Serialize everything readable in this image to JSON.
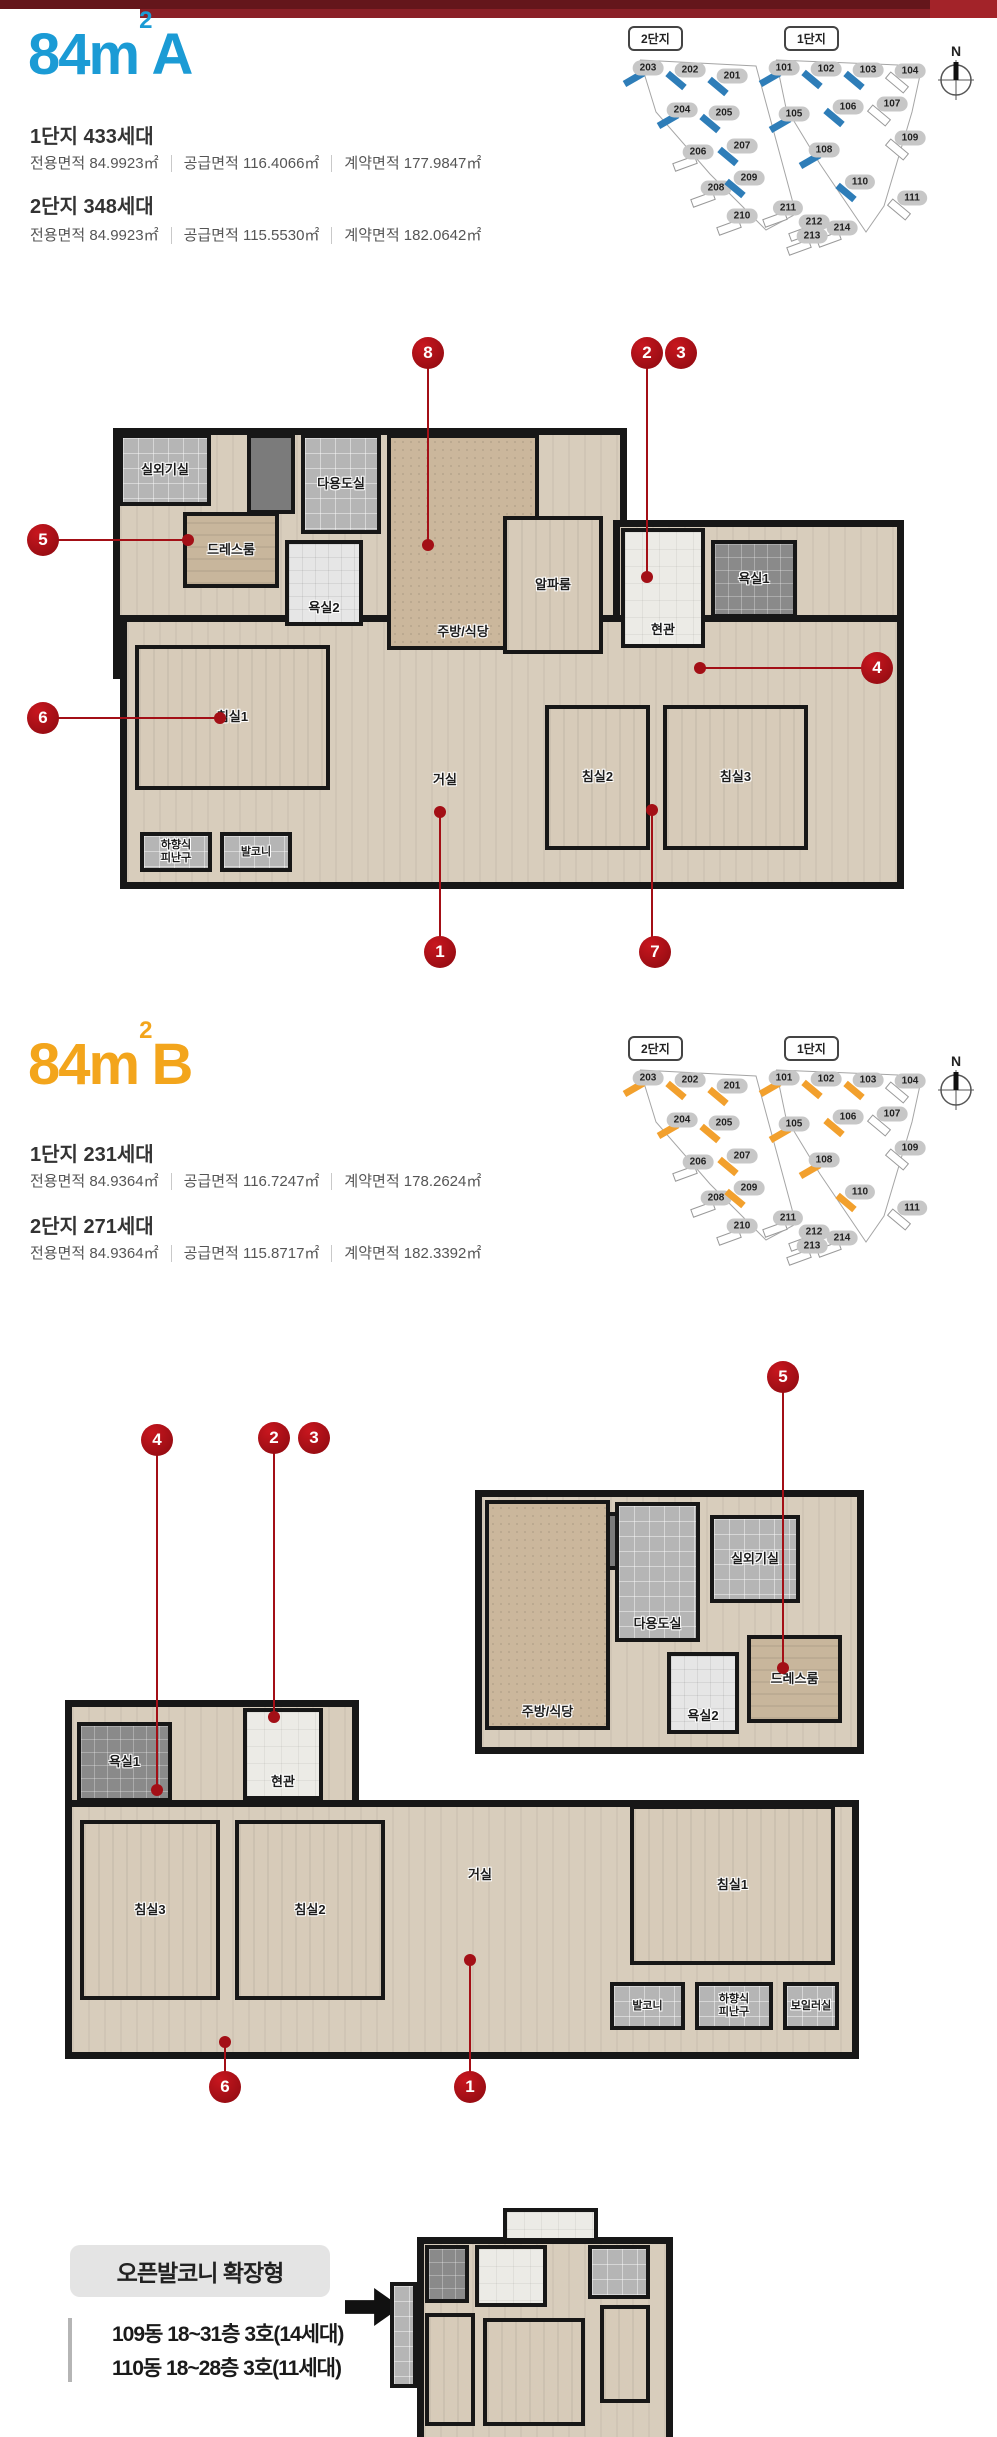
{
  "top_bar": {
    "color_left": "#64161b",
    "color_main": "#8a2027",
    "color_right": "#a32329"
  },
  "accents": {
    "marker": "#a30f16"
  },
  "site_map": {
    "labels": [
      "2단지",
      "1단지"
    ],
    "compass": "N",
    "buildings": [
      {
        "no": "203",
        "x": 32,
        "y": 52,
        "hl": true,
        "a": -30
      },
      {
        "no": "202",
        "x": 74,
        "y": 54,
        "hl": true,
        "a": 40
      },
      {
        "no": "201",
        "x": 116,
        "y": 60,
        "hl": true,
        "a": 40
      },
      {
        "no": "204",
        "x": 66,
        "y": 94,
        "hl": true,
        "a": -30
      },
      {
        "no": "205",
        "x": 108,
        "y": 97,
        "hl": true,
        "a": 40
      },
      {
        "no": "206",
        "x": 82,
        "y": 136,
        "hl": false,
        "a": -20
      },
      {
        "no": "207",
        "x": 126,
        "y": 130,
        "hl": true,
        "a": 40
      },
      {
        "no": "208",
        "x": 100,
        "y": 172,
        "hl": false,
        "a": -20
      },
      {
        "no": "209",
        "x": 133,
        "y": 162,
        "hl": true,
        "a": 40
      },
      {
        "no": "210",
        "x": 126,
        "y": 200,
        "hl": false,
        "a": -20
      },
      {
        "no": "211",
        "x": 172,
        "y": 192,
        "hl": false,
        "a": -20
      },
      {
        "no": "212",
        "x": 198,
        "y": 206,
        "hl": false,
        "a": -20
      },
      {
        "no": "214",
        "x": 226,
        "y": 212,
        "hl": false,
        "a": -20
      },
      {
        "no": "213",
        "x": 196,
        "y": 220,
        "hl": false,
        "a": -20
      },
      {
        "no": "101",
        "x": 168,
        "y": 52,
        "hl": true,
        "a": -30
      },
      {
        "no": "102",
        "x": 210,
        "y": 53,
        "hl": true,
        "a": 40
      },
      {
        "no": "103",
        "x": 252,
        "y": 54,
        "hl": true,
        "a": 40
      },
      {
        "no": "104",
        "x": 294,
        "y": 55,
        "hl": false,
        "a": 40
      },
      {
        "no": "105",
        "x": 178,
        "y": 98,
        "hl": true,
        "a": -30
      },
      {
        "no": "106",
        "x": 232,
        "y": 91,
        "hl": true,
        "a": 40
      },
      {
        "no": "107",
        "x": 276,
        "y": 88,
        "hl": false,
        "a": 40
      },
      {
        "no": "108",
        "x": 208,
        "y": 134,
        "hl": true,
        "a": -30
      },
      {
        "no": "109",
        "x": 294,
        "y": 122,
        "hl": false,
        "a": 40
      },
      {
        "no": "110",
        "x": 244,
        "y": 166,
        "hl": true,
        "a": 40
      },
      {
        "no": "111",
        "x": 296,
        "y": 182,
        "hl": false,
        "a": 40
      }
    ]
  },
  "sections": [
    {
      "id": "A",
      "title": {
        "main": "84m",
        "sup": "2",
        "type": "A",
        "color": "#1b9bd5"
      },
      "map_highlight": "#2e7db8",
      "complexes": [
        {
          "name": "1단지 433세대",
          "areas": [
            "전용면적 84.9923㎡",
            "공급면적 116.4066㎡",
            "계약면적 177.9847㎡"
          ]
        },
        {
          "name": "2단지 348세대",
          "areas": [
            "전용면적 84.9923㎡",
            "공급면적 115.5530㎡",
            "계약면적 182.0642㎡"
          ]
        }
      ],
      "plan": {
        "x": 105,
        "y": 420,
        "w": 785,
        "h": 455,
        "bases": [
          {
            "x": 8,
            "y": 8,
            "w": 500,
            "h": 237
          },
          {
            "x": 508,
            "y": 100,
            "w": 277,
            "h": 137
          },
          {
            "x": 15,
            "y": 195,
            "w": 770,
            "h": 260
          }
        ],
        "rooms": [
          {
            "id": "outdoor-unit-room",
            "label": "실외기실",
            "x": 14,
            "y": 14,
            "w": 92,
            "h": 72,
            "t": "tile"
          },
          {
            "id": "shaft",
            "x": 142,
            "y": 14,
            "w": 48,
            "h": 80,
            "t": "dark"
          },
          {
            "id": "utility-room",
            "label": "다용도실",
            "x": 196,
            "y": 14,
            "w": 80,
            "h": 100,
            "t": "tile"
          },
          {
            "id": "dress-room",
            "label": "드레스룸",
            "x": 78,
            "y": 92,
            "w": 96,
            "h": 76,
            "t": "wood2"
          },
          {
            "id": "bathroom-2",
            "label": "욕실2",
            "x": 180,
            "y": 120,
            "w": 78,
            "h": 86,
            "t": "bath2",
            "lb": true
          },
          {
            "id": "kitchen-dining",
            "label": "주방/식당",
            "x": 282,
            "y": 14,
            "w": 152,
            "h": 216,
            "t": "counter",
            "lb": true
          },
          {
            "id": "alpha-room",
            "label": "알파룸",
            "x": 398,
            "y": 96,
            "w": 100,
            "h": 138,
            "t": "wood"
          },
          {
            "id": "entrance",
            "label": "현관",
            "x": 516,
            "y": 108,
            "w": 84,
            "h": 120,
            "t": "entry",
            "lb": true
          },
          {
            "id": "bathroom-1",
            "label": "욕실1",
            "x": 606,
            "y": 120,
            "w": 86,
            "h": 78,
            "t": "bath"
          },
          {
            "id": "bedroom-1",
            "label": "침실1",
            "x": 30,
            "y": 225,
            "w": 195,
            "h": 145,
            "t": "wood"
          },
          {
            "id": "living-room",
            "label": "거실",
            "x": 280,
            "y": 330,
            "w": 120,
            "h": 60,
            "t": "none"
          },
          {
            "id": "bedroom-2",
            "label": "침실2",
            "x": 440,
            "y": 285,
            "w": 105,
            "h": 145,
            "t": "wood"
          },
          {
            "id": "bedroom-3",
            "label": "침실3",
            "x": 558,
            "y": 285,
            "w": 145,
            "h": 145,
            "t": "wood"
          },
          {
            "id": "escape-hatch",
            "label": "하향식\n피난구",
            "x": 35,
            "y": 412,
            "w": 72,
            "h": 40,
            "t": "tile",
            "s": true
          },
          {
            "id": "balcony",
            "label": "발코니",
            "x": 115,
            "y": 412,
            "w": 72,
            "h": 40,
            "t": "tile",
            "s": true
          }
        ]
      },
      "markers": [
        {
          "n": "8",
          "cx": 428,
          "cy": 353,
          "dx": 428,
          "dy": 545
        },
        {
          "n": "2",
          "cx": 647,
          "cy": 353,
          "dx": 647,
          "dy": 577
        },
        {
          "n": "3",
          "cx": 681,
          "cy": 353
        },
        {
          "n": "5",
          "cx": 43,
          "cy": 540,
          "dx": 188,
          "dy": 540
        },
        {
          "n": "6",
          "cx": 43,
          "cy": 718,
          "dx": 220,
          "dy": 718
        },
        {
          "n": "4",
          "cx": 877,
          "cy": 668,
          "dx": 700,
          "dy": 668
        },
        {
          "n": "1",
          "cx": 440,
          "cy": 952,
          "dx": 440,
          "dy": 812
        },
        {
          "n": "7",
          "cx": 655,
          "cy": 952,
          "dx": 652,
          "dy": 810
        }
      ]
    },
    {
      "id": "B",
      "title": {
        "main": "84m",
        "sup": "2",
        "type": "B",
        "color": "#f3a51c"
      },
      "map_highlight": "#f2a02d",
      "complexes": [
        {
          "name": "1단지 231세대",
          "areas": [
            "전용면적 84.9364㎡",
            "공급면적 116.7247㎡",
            "계약면적 178.2624㎡"
          ]
        },
        {
          "name": "2단지 271세대",
          "areas": [
            "전용면적 84.9364㎡",
            "공급면적 115.8717㎡",
            "계약면적 182.3392㎡"
          ]
        }
      ],
      "plan": {
        "x": 55,
        "y": 480,
        "w": 800,
        "h": 560,
        "bases": [
          {
            "x": 420,
            "y": 0,
            "w": 375,
            "h": 250
          },
          {
            "x": 10,
            "y": 210,
            "w": 280,
            "h": 110
          },
          {
            "x": 10,
            "y": 310,
            "w": 780,
            "h": 245
          }
        ],
        "rooms": [
          {
            "id": "shaft",
            "x": 438,
            "y": 22,
            "w": 130,
            "h": 58,
            "t": "dark"
          },
          {
            "id": "utility-room",
            "label": "다용도실",
            "x": 560,
            "y": 12,
            "w": 85,
            "h": 140,
            "t": "tile",
            "lb": true
          },
          {
            "id": "outdoor-unit-room",
            "label": "실외기실",
            "x": 655,
            "y": 25,
            "w": 90,
            "h": 88,
            "t": "tile"
          },
          {
            "id": "dress-room",
            "label": "드레스룸",
            "x": 692,
            "y": 145,
            "w": 95,
            "h": 88,
            "t": "wood2"
          },
          {
            "id": "bathroom-2",
            "label": "욕실2",
            "x": 612,
            "y": 162,
            "w": 72,
            "h": 82,
            "t": "bath2",
            "lb": true
          },
          {
            "id": "kitchen-dining",
            "label": "주방/식당",
            "x": 430,
            "y": 10,
            "w": 125,
            "h": 230,
            "t": "counter",
            "lb": true
          },
          {
            "id": "entrance",
            "label": "현관",
            "x": 188,
            "y": 218,
            "w": 80,
            "h": 92,
            "t": "entry",
            "lb": true
          },
          {
            "id": "bathroom-1",
            "label": "욕실1",
            "x": 22,
            "y": 232,
            "w": 95,
            "h": 80,
            "t": "bath"
          },
          {
            "id": "bedroom-3",
            "label": "침실3",
            "x": 25,
            "y": 330,
            "w": 140,
            "h": 180,
            "t": "wood"
          },
          {
            "id": "bedroom-2",
            "label": "침실2",
            "x": 180,
            "y": 330,
            "w": 150,
            "h": 180,
            "t": "wood"
          },
          {
            "id": "living-room",
            "label": "거실",
            "x": 365,
            "y": 355,
            "w": 120,
            "h": 60,
            "t": "none"
          },
          {
            "id": "bedroom-1",
            "label": "침실1",
            "x": 575,
            "y": 315,
            "w": 205,
            "h": 160,
            "t": "wood"
          },
          {
            "id": "balcony",
            "label": "발코니",
            "x": 555,
            "y": 492,
            "w": 75,
            "h": 48,
            "t": "tile",
            "s": true
          },
          {
            "id": "escape-hatch",
            "label": "하향식\n피난구",
            "x": 640,
            "y": 492,
            "w": 78,
            "h": 48,
            "t": "tile",
            "s": true
          },
          {
            "id": "boiler-room",
            "label": "보일러실",
            "x": 728,
            "y": 492,
            "w": 56,
            "h": 48,
            "t": "tile",
            "s": true
          }
        ]
      },
      "markers": [
        {
          "n": "5",
          "cx": 783,
          "cy": 367,
          "dx": 783,
          "dy": 658
        },
        {
          "n": "4",
          "cx": 157,
          "cy": 430,
          "dx": 157,
          "dy": 780
        },
        {
          "n": "2",
          "cx": 274,
          "cy": 428,
          "dx": 274,
          "dy": 707
        },
        {
          "n": "3",
          "cx": 314,
          "cy": 428
        },
        {
          "n": "6",
          "cx": 225,
          "cy": 1077,
          "dx": 225,
          "dy": 1032
        },
        {
          "n": "1",
          "cx": 470,
          "cy": 1077,
          "dx": 470,
          "dy": 950
        }
      ]
    }
  ],
  "footer": {
    "badge": "오픈발코니 확장형",
    "lines": [
      "109동 18~31층 3호(14세대)",
      "110동 18~28층 3호(11세대)"
    ],
    "mini_plan": {
      "x": 388,
      "y": 68,
      "w": 280,
      "h": 230,
      "bases": [
        {
          "x": 29,
          "y": 29,
          "w": 242,
          "h": 198
        }
      ],
      "rooms": [
        {
          "id": "upper-extension",
          "x": 115,
          "y": 0,
          "w": 95,
          "h": 34,
          "t": "entry"
        },
        {
          "id": "side-balcony",
          "x": 2,
          "y": 74,
          "w": 27,
          "h": 106,
          "t": "tile"
        },
        {
          "id": "bathroom",
          "x": 37,
          "y": 37,
          "w": 44,
          "h": 58,
          "t": "bath"
        },
        {
          "id": "entry-area",
          "x": 87,
          "y": 37,
          "w": 72,
          "h": 62,
          "t": "entry"
        },
        {
          "id": "bathroom-2",
          "x": 200,
          "y": 37,
          "w": 62,
          "h": 54,
          "t": "tile"
        },
        {
          "id": "room-right",
          "x": 212,
          "y": 97,
          "w": 50,
          "h": 98,
          "t": "wood"
        },
        {
          "id": "room-center",
          "x": 95,
          "y": 110,
          "w": 102,
          "h": 108,
          "t": "wood"
        },
        {
          "id": "room-left",
          "x": 37,
          "y": 105,
          "w": 50,
          "h": 113,
          "t": "wood"
        }
      ]
    }
  }
}
